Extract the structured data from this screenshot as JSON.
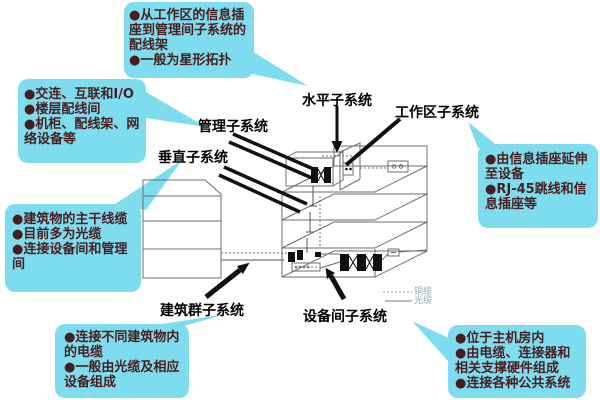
{
  "colors": {
    "background": "#ffffff",
    "callout_bg": "#7edcef",
    "callout_text": "#4a1d1d",
    "label_text": "#000000",
    "line_art": "#6e6e6e",
    "arrow_black": "#111111",
    "legend_text": "#9aa4ad"
  },
  "labels": {
    "horizontal": "水平子系统",
    "work_area": "工作区子系统",
    "management": "管理子系统",
    "vertical": "垂直子系统",
    "campus": "建筑群子系统",
    "equipment_room": "设备间子系统"
  },
  "legend": {
    "copper": "铜缆",
    "fiber": "光缆"
  },
  "callouts": {
    "horizontal_notes": {
      "items": [
        "●从工作区的信息插座到管理间子系统的配线架",
        "●一般为星形拓扑"
      ]
    },
    "management_notes": {
      "items": [
        "●交连、互联和I/O",
        "●楼层配线间",
        "●机柜、配线架、网络设备等"
      ]
    },
    "vertical_notes": {
      "items": [
        "●建筑物的主干线缆",
        "●目前多为光缆",
        "●连接设备间和管理间"
      ]
    },
    "campus_notes": {
      "items": [
        "●连接不同建筑物内的电缆",
        "●一般由光缆及相应设备组成"
      ]
    },
    "work_area_notes": {
      "items": [
        "●由信息插座延伸至设备",
        "●RJ-45跳线和信息插座等"
      ]
    },
    "equipment_room_notes": {
      "items": [
        "●位于主机房内",
        "●由电缆、连接器和相关支撑硬件组成",
        "●连接各种公共系统"
      ]
    }
  }
}
